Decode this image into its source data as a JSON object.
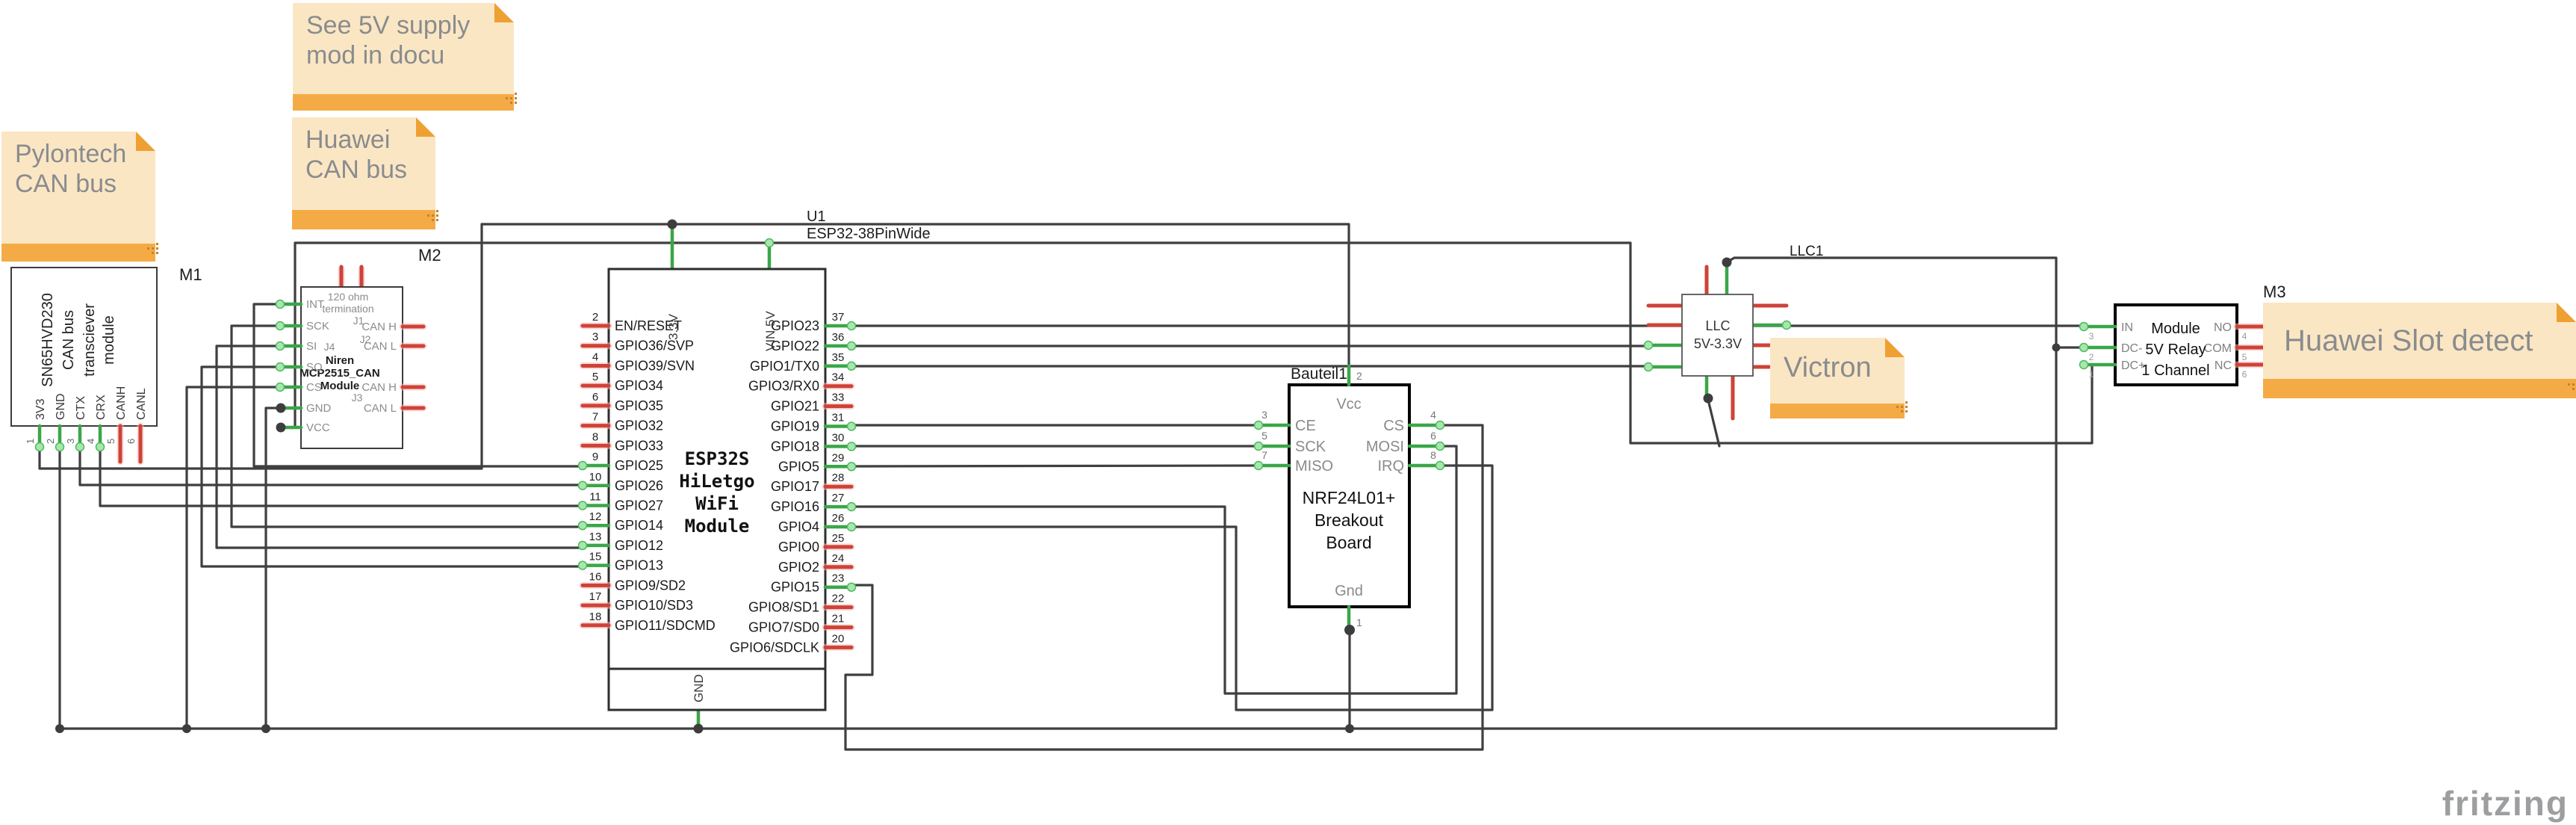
{
  "notes": {
    "see5v": {
      "text": "See 5V supply\nmod in docu"
    },
    "huawei_can": {
      "text": "Huawei\nCAN bus"
    },
    "pylontech": {
      "text": "Pylontech\nCAN bus"
    },
    "victron": {
      "text": "Victron"
    },
    "huawei_slot": {
      "text": "Huawei Slot detect"
    }
  },
  "labels": {
    "m1": "M1",
    "m2": "M2",
    "m3": "M3",
    "u1": "U1",
    "u1_part": "ESP32-38PinWide",
    "llc1": "LLC1",
    "bauteil1": "Bauteil1"
  },
  "m1": {
    "title_lines": [
      "SN65HVD230",
      "CAN bus",
      "transciever",
      "module"
    ],
    "pins": [
      {
        "n": "1",
        "label": "3V3",
        "c": "g"
      },
      {
        "n": "2",
        "label": "GND",
        "c": "g"
      },
      {
        "n": "3",
        "label": "CTX",
        "c": "g"
      },
      {
        "n": "4",
        "label": "CRX",
        "c": "g"
      },
      {
        "n": "5",
        "label": "CANH",
        "c": "r"
      },
      {
        "n": "6",
        "label": "CANL",
        "c": "r"
      }
    ]
  },
  "m2": {
    "inner": {
      "line1": "120 ohm",
      "line2": "termination",
      "j1": "J1",
      "j2": "J2",
      "j3": "J3",
      "j4": "J4",
      "name1": "Niren",
      "name2": "MCP2515_CAN",
      "name3": "Module"
    },
    "left_pins": [
      {
        "label": "INT"
      },
      {
        "label": "SCK"
      },
      {
        "label": "SI"
      },
      {
        "label": "SO"
      },
      {
        "label": "CS"
      },
      {
        "label": "GND"
      },
      {
        "label": "VCC"
      }
    ],
    "right_pins": [
      {
        "label": "CAN H"
      },
      {
        "label": "CAN L"
      },
      {
        "label": "CAN H"
      },
      {
        "label": "CAN L"
      }
    ]
  },
  "esp32": {
    "center_lines": [
      "ESP32S",
      "HiLetgo",
      "WiFi",
      "Module"
    ],
    "top_pins": [
      "3.3V",
      "VIN 5V"
    ],
    "bottom_pin": "GND",
    "left_pins": [
      {
        "n": "2",
        "label": "EN/RESET",
        "c": "r"
      },
      {
        "n": "3",
        "label": "GPIO36/SVP",
        "c": "r"
      },
      {
        "n": "4",
        "label": "GPIO39/SVN",
        "c": "r"
      },
      {
        "n": "5",
        "label": "GPIO34",
        "c": "r"
      },
      {
        "n": "6",
        "label": "GPIO35",
        "c": "r"
      },
      {
        "n": "7",
        "label": "GPIO32",
        "c": "r"
      },
      {
        "n": "8",
        "label": "GPIO33",
        "c": "r"
      },
      {
        "n": "9",
        "label": "GPIO25",
        "c": "g"
      },
      {
        "n": "10",
        "label": "GPIO26",
        "c": "g"
      },
      {
        "n": "11",
        "label": "GPIO27",
        "c": "g"
      },
      {
        "n": "12",
        "label": "GPIO14",
        "c": "g"
      },
      {
        "n": "13",
        "label": "GPIO12",
        "c": "g"
      },
      {
        "n": "15",
        "label": "GPIO13",
        "c": "g"
      },
      {
        "n": "16",
        "label": "GPIO9/SD2",
        "c": "r"
      },
      {
        "n": "17",
        "label": "GPIO10/SD3",
        "c": "r"
      },
      {
        "n": "18",
        "label": "GPIO11/SDCMD",
        "c": "r"
      }
    ],
    "right_pins": [
      {
        "n": "37",
        "label": "GPIO23",
        "c": "g"
      },
      {
        "n": "36",
        "label": "GPIO22",
        "c": "g"
      },
      {
        "n": "35",
        "label": "GPIO1/TX0",
        "c": "g"
      },
      {
        "n": "34",
        "label": "GPIO3/RX0",
        "c": "r"
      },
      {
        "n": "33",
        "label": "GPIO21",
        "c": "r"
      },
      {
        "n": "31",
        "label": "GPIO19",
        "c": "g"
      },
      {
        "n": "30",
        "label": "GPIO18",
        "c": "g"
      },
      {
        "n": "29",
        "label": "GPIO5",
        "c": "g"
      },
      {
        "n": "28",
        "label": "GPIO17",
        "c": "r"
      },
      {
        "n": "27",
        "label": "GPIO16",
        "c": "g"
      },
      {
        "n": "26",
        "label": "GPIO4",
        "c": "g"
      },
      {
        "n": "25",
        "label": "GPIO0",
        "c": "r"
      },
      {
        "n": "24",
        "label": "GPIO2",
        "c": "r"
      },
      {
        "n": "23",
        "label": "GPIO15",
        "c": "g"
      },
      {
        "n": "22",
        "label": "GPIO8/SD1",
        "c": "r"
      },
      {
        "n": "21",
        "label": "GPIO7/SD0",
        "c": "r"
      },
      {
        "n": "20",
        "label": "GPIO6/SDCLK",
        "c": "r"
      }
    ]
  },
  "nrf": {
    "center_lines": [
      "NRF24L01+",
      "Breakout",
      "Board"
    ],
    "top": {
      "n": "2",
      "label": "Vcc"
    },
    "bottom": {
      "n": "1",
      "label": "Gnd"
    },
    "left": [
      {
        "n": "3",
        "label": "CE"
      },
      {
        "n": "5",
        "label": "SCK"
      },
      {
        "n": "7",
        "label": "MISO"
      }
    ],
    "right": [
      {
        "n": "4",
        "label": "CS"
      },
      {
        "n": "6",
        "label": "MOSI"
      },
      {
        "n": "8",
        "label": "IRQ"
      }
    ]
  },
  "llc": {
    "line1": "LLC",
    "line2": "5V-3.3V"
  },
  "relay": {
    "center_lines": [
      "Module",
      "5V Relay",
      "1 Channel"
    ],
    "left": [
      {
        "n": "3",
        "label": "IN"
      },
      {
        "n": "2",
        "label": "DC-"
      },
      {
        "n": "1",
        "label": "DC+"
      }
    ],
    "right": [
      {
        "n": "4",
        "label": "NO"
      },
      {
        "n": "5",
        "label": "COM"
      },
      {
        "n": "6",
        "label": "NC"
      }
    ]
  },
  "watermark": "fritzing",
  "colors": {
    "wire": "#3f3f3f",
    "green_pin": "#3aa648",
    "red_pin": "#cf4238",
    "note_bg": "#fbe6c4",
    "note_strip": "#f5ab45",
    "accent": "#eea033"
  }
}
